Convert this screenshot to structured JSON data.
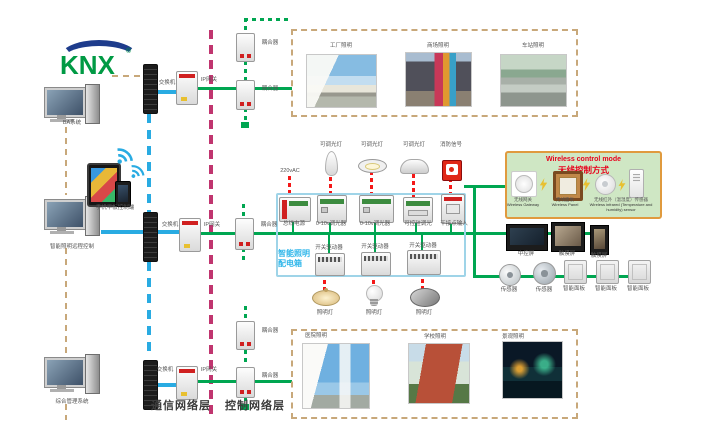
{
  "brand": {
    "name": "KNX",
    "reg": "®"
  },
  "left_side": {
    "ba_system": "BA系统",
    "mobile_control": "手机平板控制端",
    "remote_control": "智能照明远程控制",
    "management_system": "综合管理系统"
  },
  "network": {
    "switch": "交换机",
    "ip_gateway": "IP网关",
    "coupler": "耦合器",
    "comm_layer": "通信网络层",
    "control_layer": "控制网络层"
  },
  "panel_box": {
    "title_line1": "智能照明",
    "title_line2": "配电箱",
    "power_in": "220vAC",
    "dimmable_lamp": "可调光灯",
    "fire_signal": "消防信号",
    "bus_power": "总线电源",
    "dimmer_0_10v": "0-10v调光器",
    "scr_dimmer": "可控硅调光",
    "dry_contact": "干接点输入",
    "switch_actuator": "开关驱动器",
    "lighting_lamp": "照明灯"
  },
  "wireless": {
    "title_en": "Wireless control mode",
    "title_zh": "无线控制方式",
    "gateway_zh": "无线网关",
    "gateway_en": "Wireless Gateway",
    "panel_zh": "无线面板",
    "panel_en": "Wireless Panel",
    "sensor_zh": "无线红外（温湿度）传感器",
    "sensor_en": "Wireless infrared (Temperature and humidity) sensor"
  },
  "control_devices": {
    "central_screen": "中控屏",
    "touch_screen": "触摸屏",
    "sensor": "传感器",
    "smart_panel": "智能面板"
  },
  "applications_top": [
    "工厂照明",
    "商场照明",
    "车站照明"
  ],
  "applications_bottom": [
    "医院照明",
    "学校照明",
    "景观照明"
  ],
  "icons": {
    "wifi": "wifi-icon",
    "lightning": "lightning-icon"
  },
  "colors": {
    "bus_green": "#00a651",
    "comm_blue": "#29abe2",
    "power_red": "#f41818",
    "layer_magenta": "#c0356f",
    "dash_tan": "#c8a87a",
    "panel_border_cyan": "#9fd4e8",
    "panel_label_cyan": "#2eb6ea",
    "wireless_bg": "#cfe7c4",
    "wireless_border": "#e09a3e",
    "wireless_title_red": "#e8001c",
    "knx_green": "#009a44",
    "knx_blue": "#1e3c8c"
  }
}
